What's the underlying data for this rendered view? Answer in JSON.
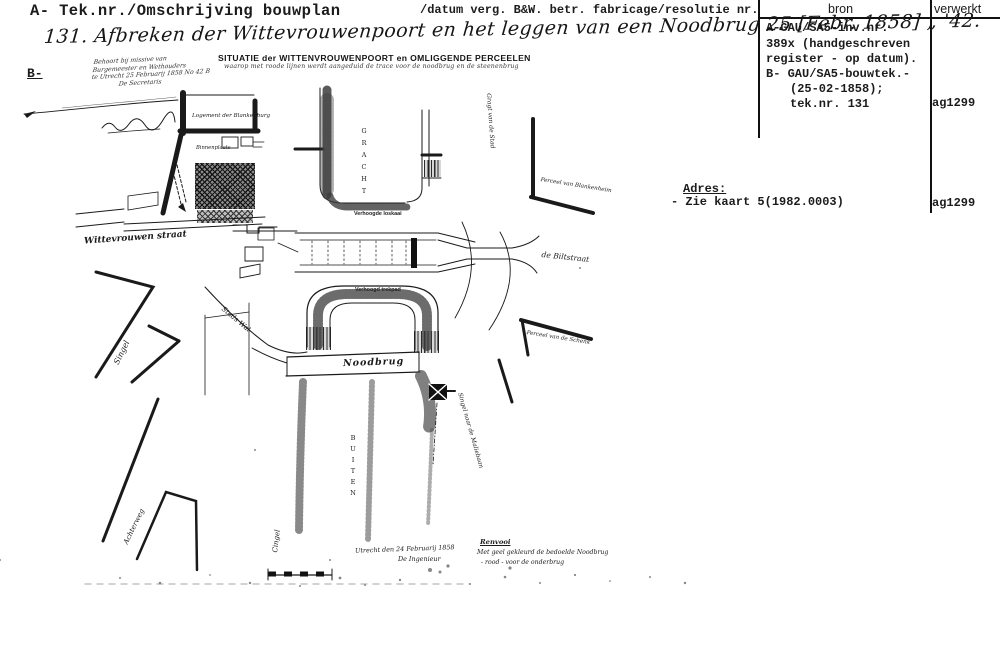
{
  "header": {
    "left_label": "A- Tek.nr./Omschrijving bouwplan",
    "right_label": "/datum verg. B&W. betr. fabricage/resolutie nr."
  },
  "record_table": {
    "col_bron": "bron",
    "col_verwerkt": "verwerkt",
    "bron_lines": [
      "A-GAU/SA5-inv.nr.",
      "389x (handgeschreven",
      "register - op datum).",
      "B- GAU/SA5-bouwtek.-",
      "(25-02-1858);",
      "tek.nr. 131"
    ],
    "verwerkt_value_1": "ag1299",
    "adres_label": "Adres:",
    "adres_value": "- Zie kaart 5(1982.0003)",
    "verwerkt_value_2": "ag1299"
  },
  "entry": {
    "handwritten_title": "131.   Afbreken der Wittevrouwenpoort en het leggen van een Noodbrug  25 [Febr. 1858]   „   '42.",
    "section_label": "B-"
  },
  "map": {
    "title": "SITUATIE der WITTENVROUWENPOORT en OMLIGGENDE PERCEELEN",
    "subtitle": "waarop met roode lijnen werdt aangeduid de trace voor de noodbrug en de steenenbrug",
    "note_lines": [
      "Behoort bij missive van",
      "Burgemeester en Wethouders",
      "te Utrecht 25 Februarij 1858 No 42 B",
      "De Secretaris"
    ],
    "labels": {
      "logement": "Logement der Blankenburg",
      "binnenplaats": "Binnenplaats",
      "wittevrouwenstraat": "Wittevrouwen straat",
      "gracht": "GRACHT",
      "verhoogde_loskaai": "Verhoogde loskaai",
      "verhoogd_trekpad": "Verhoogd trekpad",
      "noodbrug": "Noodbrug",
      "singel": "Singel",
      "stadswal": "Stads Wal",
      "buiten": "BUITEN",
      "cingel": "Cingel",
      "achterweg": "Achterweg",
      "perceel_blankenheim": "Perceel van Blankenheim",
      "biltstraat": "de Biltstraat",
      "perceel_schenk": "Perceel van de Schenk",
      "gracht_stad": "Gragt van de Stad",
      "singel_maliebaan": "Singel naar de Maliebaan",
      "datum_regel": "Utrecht den 24 Februarij 1858",
      "ingenieur": "De Ingenieur",
      "renvooi": "Renvooi",
      "renvooi_line1": "Met geel gekleurd de bedoelde Noodbrug",
      "renvooi_line2": "-  rood  -      voor de onderbrug"
    }
  }
}
